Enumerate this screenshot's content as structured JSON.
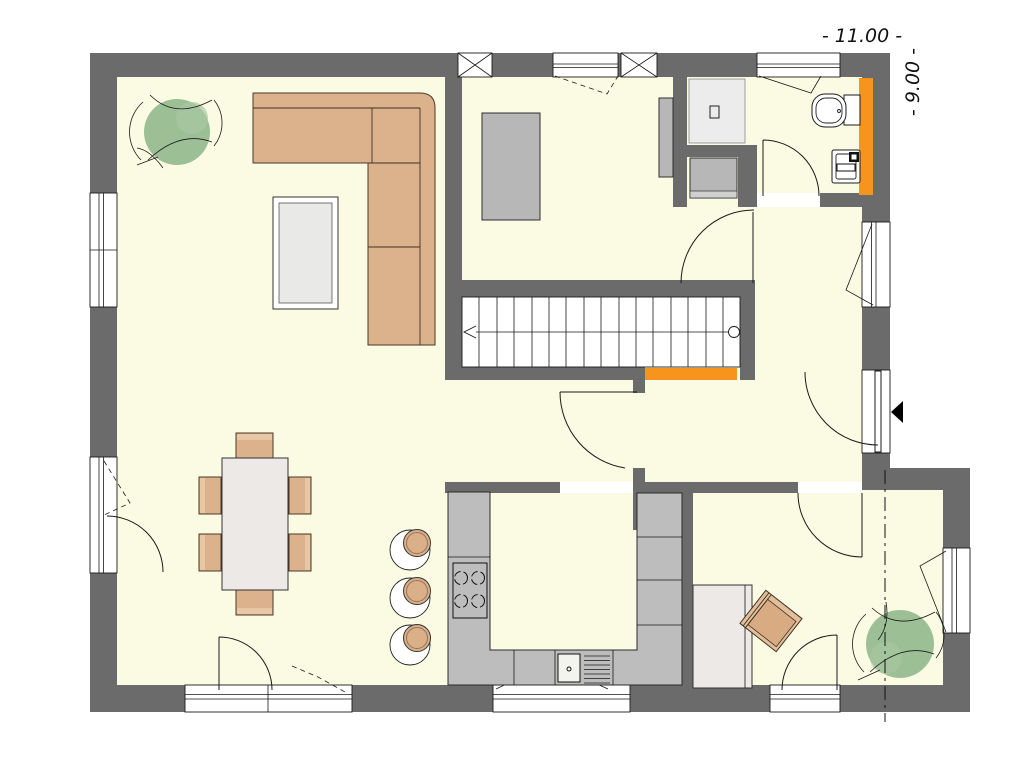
{
  "page": {
    "type": "architectural-floor-plan",
    "background": "#ffffff"
  },
  "dimensions": {
    "width_label": "- 11.00 -",
    "height_label": "- 9.00 -",
    "width_m": 11.0,
    "height_m": 9.0
  },
  "colors": {
    "wall": "#6b6b6b",
    "floor": "#fbfbe4",
    "accent_orange": "#f7941d",
    "furniture_tan": "#dcb28c",
    "plant_green": "#92b88d",
    "counter_gray": "#bdbdbd",
    "fixture_gray": "#b7b7b7",
    "table_light": "#ece9e6"
  },
  "staircase": {
    "treads": 16,
    "walk_line_start_marker": "circle-right",
    "walk_line_arrow": "points-left"
  },
  "elements": [
    "l-shaped-sofa",
    "coffee-table",
    "plant-living-room",
    "dining-table",
    "dining-chairs-x6",
    "terrace-door",
    "french-door",
    "kitchen-u-counter",
    "cooktop-4-burners",
    "kitchen-sink-with-drainboard",
    "bar-stools-x3",
    "staircase-16-treads",
    "understair-orange-strip",
    "study-bed",
    "wardrobe",
    "shower-with-drain",
    "washing-machine",
    "toilet",
    "bathroom-sink",
    "bathroom-orange-wall-strip",
    "entrance-door-with-arrow",
    "hall-window",
    "office-desk",
    "office-chair",
    "plant-office",
    "section-line",
    "chimney-shafts-x2"
  ]
}
